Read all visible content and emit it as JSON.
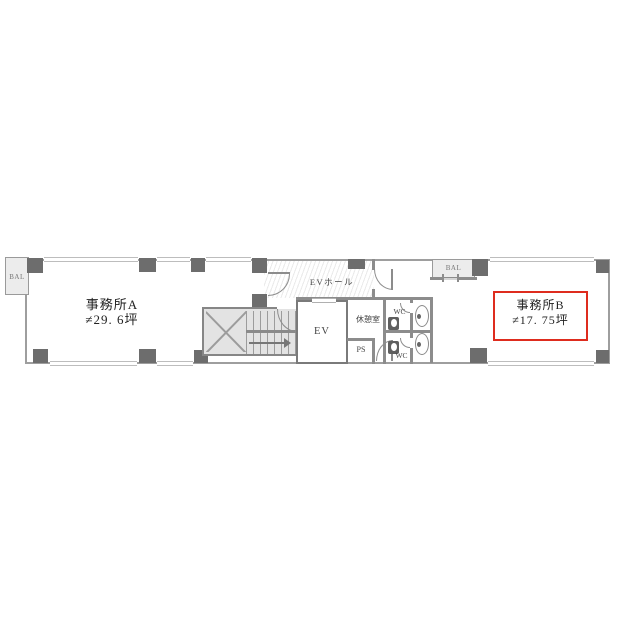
{
  "floor_plan": {
    "rooms": {
      "office_a": {
        "name": "事務所A",
        "area": "≠29. 6坪"
      },
      "office_b": {
        "name": "事務所B",
        "area": "≠17. 75坪"
      },
      "ev_hall": {
        "label": "EVホール"
      },
      "elevator": {
        "label": "EV"
      },
      "rest_room": {
        "label": "休憩室"
      },
      "pipe_shaft": {
        "label": "PS"
      },
      "wc_north": {
        "label": "WC"
      },
      "wc_south": {
        "label": "WC"
      },
      "balcony_left": {
        "label": "BAL"
      },
      "balcony_right": {
        "label": "BAL"
      }
    },
    "colors": {
      "wall": "#8c8c8c",
      "column": "#6d6d6d",
      "highlight_border": "#de2c1e",
      "stair_fill": "#e3e3e3",
      "balcony_fill": "#ececec"
    },
    "icons": [
      "door-swing-icon",
      "toilet-icon",
      "basin-icon",
      "stair-arrow-icon",
      "elevator-door-icon",
      "window-icon"
    ]
  }
}
